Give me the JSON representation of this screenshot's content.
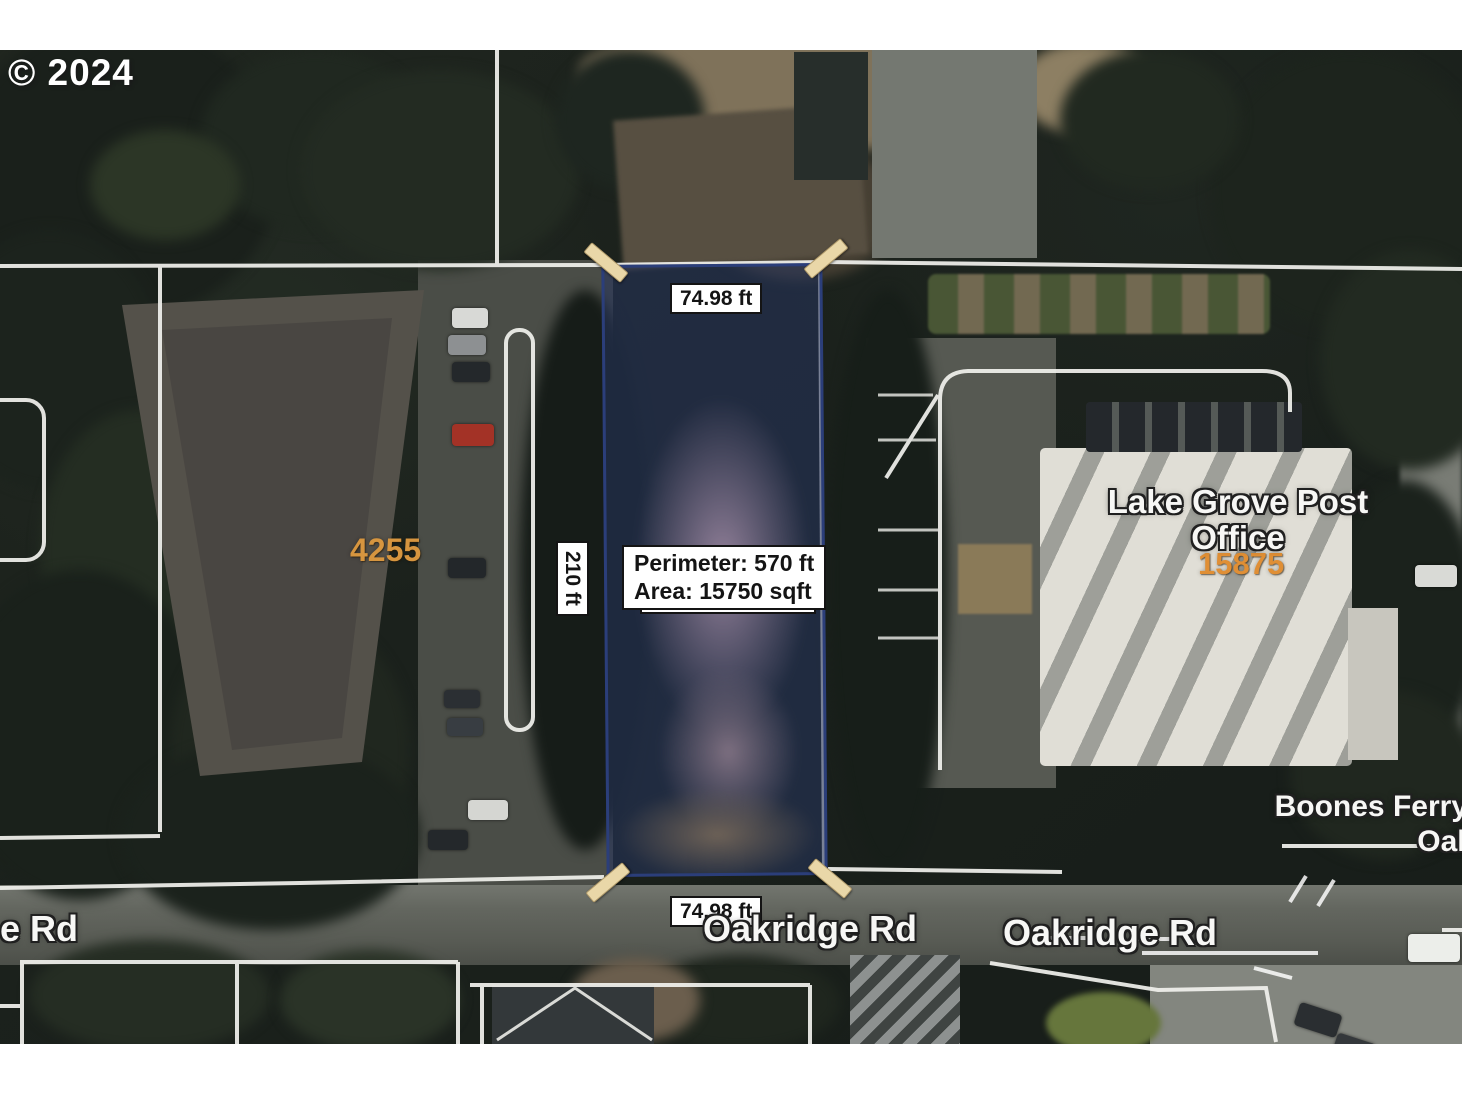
{
  "copyright_text": "© 2024",
  "measurements": {
    "top_width": "74.98 ft",
    "bottom_width": "74.98 ft",
    "side_depth": "210 ft",
    "perimeter": "Perimeter: 570 ft",
    "area": "Area: 15750 sqft"
  },
  "labels": {
    "post_office": "Lake Grove Post Office",
    "post_office_number": "15875",
    "building_number_left": "4255",
    "oakridge_center": "Oakridge Rd",
    "oakridge_right": "Oakridge Rd",
    "oakridge_left_partial": "e Rd",
    "boones_ferry_line1": "Boones Ferry",
    "boones_ferry_line2": "Oak"
  },
  "colors": {
    "parcel_outline": "#2b3e7a",
    "parcel_fill": "rgba(38,52,94,0.55)",
    "corner_marker": "#e9d7a8",
    "address_orange": "#d6953f",
    "survey_line": "#f2f2ee",
    "label_white": "#f7f7f5",
    "road_gray": "#6b6e69"
  }
}
